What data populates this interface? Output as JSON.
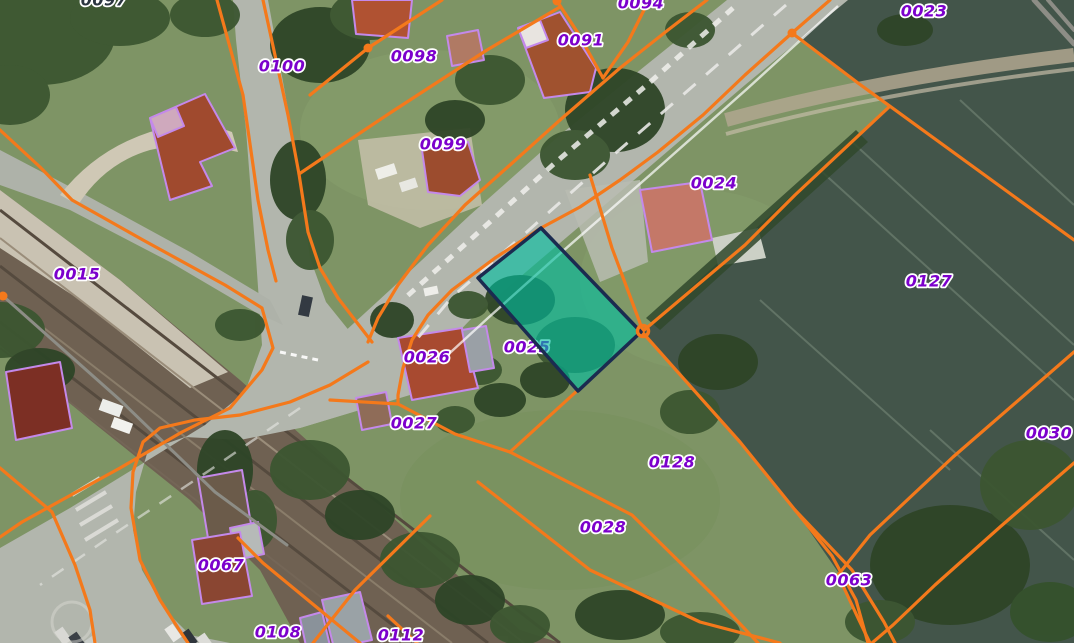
{
  "map": {
    "type": "cadastral-aerial-view",
    "palette": {
      "boundary_orange": "#f4791b",
      "label_purple": "#7c00cc",
      "label_dark": "#2b3540",
      "selected_fill": "#00bfa0",
      "selected_stroke": "#1b2b50",
      "building_outline": "#c489ea",
      "gray_boundary": "#8d8d86"
    },
    "selected_parcel": {
      "id": "0025",
      "points": [
        [
          541,
          228
        ],
        [
          641,
          332
        ],
        [
          578,
          391
        ],
        [
          478,
          278
        ]
      ]
    },
    "parcel_labels": [
      {
        "id": "0097",
        "x": 104,
        "y": 0,
        "variant": "dark-partial"
      },
      {
        "id": "0094",
        "x": 641,
        "y": 3,
        "variant": "partial"
      },
      {
        "id": "0100",
        "x": 282,
        "y": 66
      },
      {
        "id": "0098",
        "x": 414,
        "y": 56
      },
      {
        "id": "0091",
        "x": 581,
        "y": 40
      },
      {
        "id": "0023",
        "x": 924,
        "y": 11
      },
      {
        "id": "0099",
        "x": 443,
        "y": 144
      },
      {
        "id": "0024",
        "x": 714,
        "y": 183
      },
      {
        "id": "0015",
        "x": 77,
        "y": 274
      },
      {
        "id": "0127",
        "x": 929,
        "y": 281
      },
      {
        "id": "0026",
        "x": 427,
        "y": 357
      },
      {
        "id": "0025",
        "x": 527,
        "y": 347,
        "under": true
      },
      {
        "id": "0027",
        "x": 414,
        "y": 423
      },
      {
        "id": "0030",
        "x": 1049,
        "y": 433
      },
      {
        "id": "0128",
        "x": 672,
        "y": 462
      },
      {
        "id": "0028",
        "x": 603,
        "y": 527
      },
      {
        "id": "0067",
        "x": 221,
        "y": 565
      },
      {
        "id": "0063",
        "x": 849,
        "y": 580
      },
      {
        "id": "0108",
        "x": 278,
        "y": 632
      },
      {
        "id": "0112",
        "x": 401,
        "y": 635
      }
    ],
    "vertex_nodes": [
      {
        "kind": "dot",
        "x": 368,
        "y": 48
      },
      {
        "kind": "dot",
        "x": 557,
        "y": 1
      },
      {
        "kind": "dot",
        "x": 3,
        "y": 296
      },
      {
        "kind": "dot",
        "x": 792,
        "y": 33
      },
      {
        "kind": "ring",
        "x": 643,
        "y": 331
      }
    ],
    "boundary_lines": [
      {
        "name": "vroad-west",
        "points": [
          [
            217,
            0
          ],
          [
            243,
            95
          ],
          [
            258,
            200
          ],
          [
            268,
            250
          ],
          [
            276,
            281
          ]
        ]
      },
      {
        "name": "vroad-east-front",
        "points": [
          [
            263,
            0
          ],
          [
            288,
            115
          ],
          [
            299,
            174
          ],
          [
            308,
            232
          ],
          [
            320,
            268
          ],
          [
            338,
            298
          ],
          [
            358,
            324
          ],
          [
            372,
            342
          ]
        ]
      },
      {
        "name": "front-0098-0091",
        "points": [
          [
            560,
            7
          ],
          [
            487,
            50
          ],
          [
            390,
            113
          ],
          [
            360,
            133
          ],
          [
            299,
            174
          ]
        ]
      },
      {
        "name": "line-0098-west",
        "points": [
          [
            442,
            0
          ],
          [
            368,
            48
          ],
          [
            310,
            95
          ]
        ]
      },
      {
        "name": "line-0091-west",
        "points": [
          [
            603,
            78
          ],
          [
            578,
            33
          ],
          [
            557,
            1
          ]
        ]
      },
      {
        "name": "line-0091-east",
        "points": [
          [
            603,
            78
          ],
          [
            628,
            42
          ],
          [
            649,
            0
          ]
        ]
      },
      {
        "name": "road-north-edge",
        "points": [
          [
            707,
            0
          ],
          [
            668,
            30
          ],
          [
            620,
            68
          ],
          [
            560,
            120
          ],
          [
            510,
            165
          ],
          [
            465,
            205
          ],
          [
            428,
            245
          ],
          [
            398,
            285
          ],
          [
            378,
            318
          ],
          [
            368,
            342
          ]
        ]
      },
      {
        "name": "front-southeast",
        "points": [
          [
            792,
            33
          ],
          [
            745,
            75
          ],
          [
            703,
            115
          ],
          [
            658,
            152
          ],
          [
            620,
            180
          ],
          [
            580,
            207
          ],
          [
            541,
            228
          ],
          [
            495,
            258
          ],
          [
            452,
            290
          ],
          [
            428,
            315
          ],
          [
            412,
            340
          ],
          [
            403,
            368
          ],
          [
            398,
            395
          ],
          [
            398,
            404
          ]
        ]
      },
      {
        "name": "line-0027-east",
        "points": [
          [
            330,
            400
          ],
          [
            398,
            404
          ],
          [
            455,
            434
          ],
          [
            510,
            452
          ]
        ]
      },
      {
        "name": "node-east-line",
        "points": [
          [
            830,
            0
          ],
          [
            792,
            33
          ],
          [
            858,
            83
          ],
          [
            1074,
            240
          ]
        ]
      },
      {
        "name": "line-0024-east",
        "points": [
          [
            889,
            107
          ],
          [
            795,
            195
          ],
          [
            745,
            245
          ],
          [
            643,
            331
          ]
        ]
      },
      {
        "name": "line-0024-west",
        "points": [
          [
            590,
            175
          ],
          [
            612,
            248
          ],
          [
            643,
            331
          ]
        ]
      },
      {
        "name": "field-west",
        "points": [
          [
            643,
            333
          ],
          [
            740,
            442
          ],
          [
            795,
            510
          ]
        ]
      },
      {
        "name": "line-0063-west",
        "points": [
          [
            795,
            510
          ],
          [
            832,
            556
          ],
          [
            856,
            600
          ],
          [
            868,
            643
          ]
        ]
      },
      {
        "name": "line-0063-east",
        "points": [
          [
            795,
            510
          ],
          [
            852,
            570
          ],
          [
            884,
            622
          ],
          [
            895,
            643
          ]
        ]
      },
      {
        "name": "line-0030-west",
        "points": [
          [
            1074,
            352
          ],
          [
            953,
            457
          ],
          [
            870,
            535
          ],
          [
            838,
            575
          ],
          [
            858,
            618
          ],
          [
            870,
            643
          ]
        ]
      },
      {
        "name": "line-0030-south",
        "points": [
          [
            1074,
            463
          ],
          [
            1000,
            527
          ],
          [
            935,
            585
          ],
          [
            893,
            625
          ],
          [
            872,
            643
          ]
        ]
      },
      {
        "name": "line-0128-north",
        "points": [
          [
            578,
            390
          ],
          [
            510,
            452
          ]
        ]
      },
      {
        "name": "line-0128-south",
        "points": [
          [
            510,
            452
          ],
          [
            632,
            515
          ],
          [
            715,
            597
          ],
          [
            758,
            643
          ]
        ]
      },
      {
        "name": "line-0028-south",
        "points": [
          [
            478,
            482
          ],
          [
            590,
            570
          ],
          [
            700,
            622
          ],
          [
            780,
            643
          ]
        ]
      },
      {
        "name": "curve-0067-west",
        "points": [
          [
            368,
            362
          ],
          [
            330,
            385
          ],
          [
            290,
            402
          ],
          [
            240,
            415
          ],
          [
            195,
            420
          ],
          [
            160,
            428
          ],
          [
            143,
            442
          ],
          [
            133,
            472
          ],
          [
            131,
            508
          ],
          [
            140,
            560
          ],
          [
            160,
            600
          ],
          [
            178,
            628
          ],
          [
            188,
            643
          ]
        ]
      },
      {
        "name": "line-0015-east",
        "points": [
          [
            0,
            130
          ],
          [
            40,
            167
          ],
          [
            72,
            200
          ],
          [
            143,
            240
          ],
          [
            225,
            285
          ],
          [
            262,
            308
          ],
          [
            273,
            348
          ],
          [
            262,
            370
          ],
          [
            230,
            408
          ],
          [
            182,
            432
          ],
          [
            120,
            468
          ],
          [
            80,
            490
          ],
          [
            22,
            522
          ],
          [
            0,
            537
          ]
        ]
      },
      {
        "name": "line-0067-east",
        "points": [
          [
            238,
            538
          ],
          [
            263,
            563
          ],
          [
            360,
            643
          ]
        ]
      },
      {
        "name": "line-0108-east",
        "points": [
          [
            430,
            516
          ],
          [
            355,
            590
          ],
          [
            313,
            643
          ]
        ]
      },
      {
        "name": "line-0112-east",
        "points": [
          [
            388,
            616
          ],
          [
            417,
            643
          ]
        ]
      },
      {
        "name": "line-parking-west",
        "points": [
          [
            0,
            468
          ],
          [
            52,
            512
          ],
          [
            75,
            565
          ],
          [
            90,
            610
          ],
          [
            95,
            643
          ]
        ]
      }
    ],
    "gray_lines": [
      {
        "name": "path-top-right-a",
        "points": [
          [
            1034,
            0
          ],
          [
            1074,
            44
          ]
        ],
        "w": 5
      },
      {
        "name": "path-top-right-b",
        "points": [
          [
            1048,
            0
          ],
          [
            1074,
            30
          ]
        ],
        "w": 4
      },
      {
        "name": "gray-boundary-west",
        "points": [
          [
            3,
            296
          ],
          [
            120,
            400
          ],
          [
            215,
            492
          ],
          [
            287,
            545
          ]
        ],
        "w": 3
      }
    ]
  }
}
